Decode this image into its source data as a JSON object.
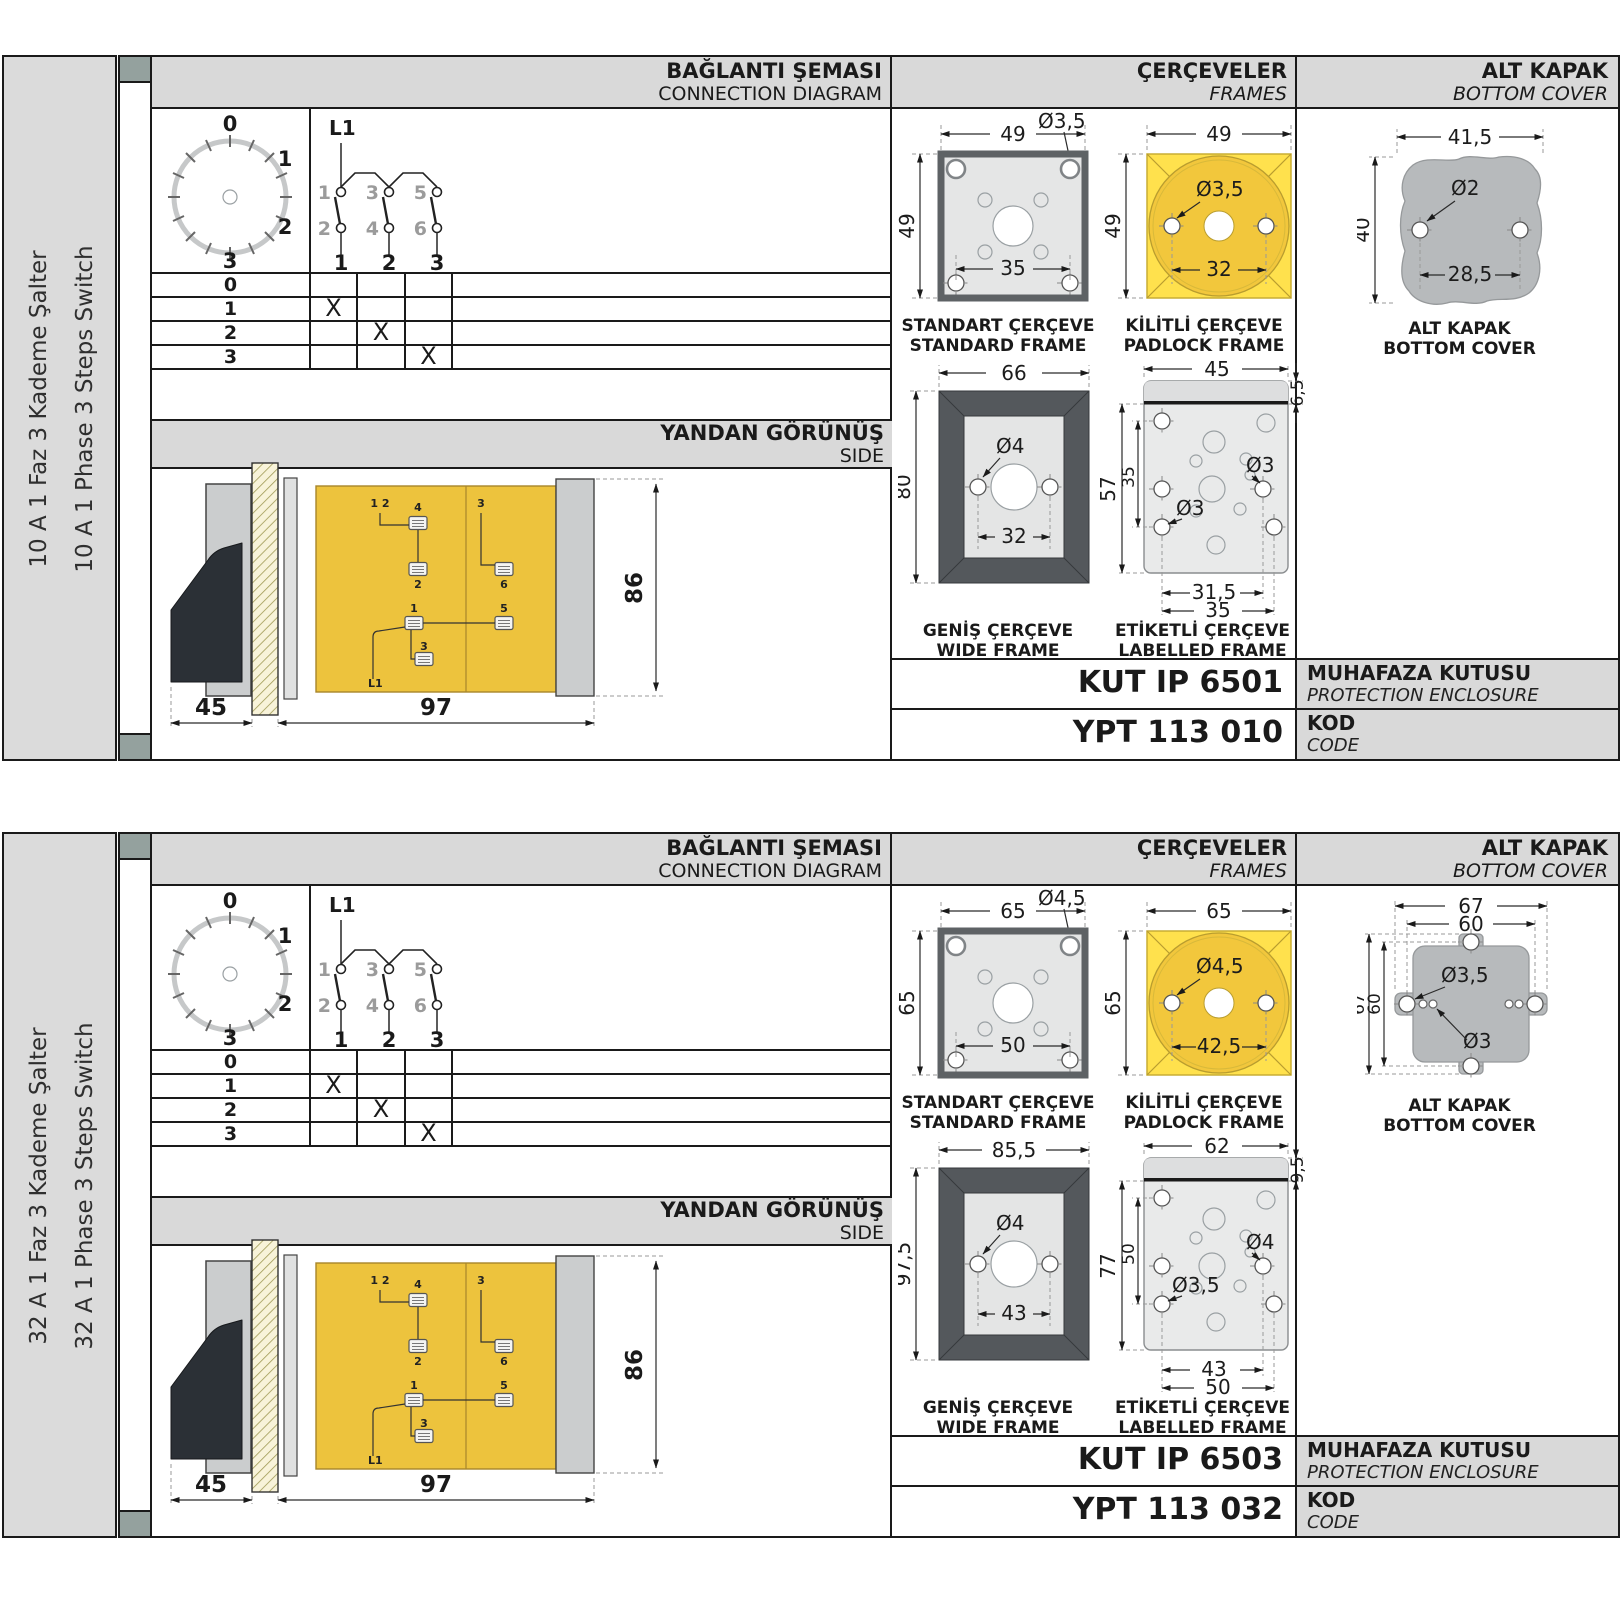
{
  "colors": {
    "panel_gray": "#d9d9d9",
    "sidebar_gray": "#dbdbdb",
    "square_teal": "#94a19e",
    "yellow_frame": "#ffe14d",
    "yellow_circle": "#f2c73c",
    "body_yellow": "#edc33d",
    "dark_frame": "#54585c",
    "cover_gray": "#b7babc"
  },
  "panels": [
    {
      "sidebar": {
        "tr": "10 A 1 Faz 3 Kademe Şalter",
        "en": "10 A 1 Phase 3 Steps Switch"
      },
      "header": {
        "connection_tr": "BAĞLANTI ŞEMASI",
        "connection_en": "CONNECTION DIAGRAM",
        "frames_tr": "ÇERÇEVELER",
        "frames_en": "FRAMES",
        "cover_tr": "ALT KAPAK",
        "cover_en": "BOTTOM COVER"
      },
      "diagram": {
        "phase": "L1",
        "dial": {
          "p0": "0",
          "p1": "1",
          "p2": "2",
          "p3": "3"
        },
        "t1": "1",
        "t2": "2",
        "t3": "3",
        "t4": "4",
        "t5": "5",
        "t6": "6",
        "c1": "1",
        "c2": "2",
        "c3": "3",
        "rows": [
          {
            "pos": "0",
            "m1": "",
            "m2": "",
            "m3": ""
          },
          {
            "pos": "1",
            "m1": "X",
            "m2": "",
            "m3": ""
          },
          {
            "pos": "2",
            "m1": "",
            "m2": "X",
            "m3": ""
          },
          {
            "pos": "3",
            "m1": "",
            "m2": "",
            "m3": "X"
          }
        ]
      },
      "side": {
        "title_tr": "YANDAN GÖRÜNÜŞ",
        "title_en": "SIDE",
        "dim_a": "45",
        "dim_b": "97",
        "dim_h": "86",
        "labels": {
          "n12": "1 2",
          "n3t": "3",
          "n4": "4",
          "n2": "2",
          "n6": "6",
          "n1": "1",
          "n5": "5",
          "n3b": "3",
          "phase": "L1"
        }
      },
      "frames": {
        "standard": {
          "title_tr": "STANDART ÇERÇEVE",
          "title_en": "STANDARD FRAME",
          "w": "49",
          "h": "49",
          "hole": "Ø3,5",
          "span": "35"
        },
        "padlock": {
          "title_tr": "KİLİTLİ ÇERÇEVE",
          "title_en": "PADLOCK FRAME",
          "w": "49",
          "h": "49",
          "hole": "Ø3,5",
          "span": "32"
        },
        "wide": {
          "title_tr": "GENİŞ ÇERÇEVE",
          "title_en": "WIDE FRAME",
          "w": "66",
          "h": "80",
          "hole": "Ø4",
          "span": "32"
        },
        "labelled": {
          "title_tr": "ETİKETLİ ÇERÇEVE",
          "title_en": "LABELLED FRAME",
          "w": "45",
          "band": "6,5",
          "h": "57",
          "inner_h": "35",
          "hole_mid": "Ø3",
          "hole_bot": "Ø3",
          "span_inner": "31,5",
          "span_outer": "35"
        }
      },
      "cover": {
        "caption_tr": "ALT KAPAK",
        "caption_en": "BOTTOM COVER",
        "w": "41,5",
        "h": "40",
        "hole": "Ø2",
        "span": "28,5"
      },
      "enclosure": {
        "code": "KUT IP 6501",
        "label_tr": "MUHAFAZA KUTUSU",
        "label_en": "PROTECTION ENCLOSURE"
      },
      "kod": {
        "code": "YPT 113 010",
        "label_tr": "KOD",
        "label_en": "CODE"
      }
    },
    {
      "sidebar": {
        "tr": "32 A 1 Faz 3 Kademe Şalter",
        "en": "32 A 1 Phase 3 Steps Switch"
      },
      "header": {
        "connection_tr": "BAĞLANTI ŞEMASI",
        "connection_en": "CONNECTION DIAGRAM",
        "frames_tr": "ÇERÇEVELER",
        "frames_en": "FRAMES",
        "cover_tr": "ALT KAPAK",
        "cover_en": "BOTTOM COVER"
      },
      "diagram": {
        "phase": "L1",
        "dial": {
          "p0": "0",
          "p1": "1",
          "p2": "2",
          "p3": "3"
        },
        "t1": "1",
        "t2": "2",
        "t3": "3",
        "t4": "4",
        "t5": "5",
        "t6": "6",
        "c1": "1",
        "c2": "2",
        "c3": "3",
        "rows": [
          {
            "pos": "0",
            "m1": "",
            "m2": "",
            "m3": ""
          },
          {
            "pos": "1",
            "m1": "X",
            "m2": "",
            "m3": ""
          },
          {
            "pos": "2",
            "m1": "",
            "m2": "X",
            "m3": ""
          },
          {
            "pos": "3",
            "m1": "",
            "m2": "",
            "m3": "X"
          }
        ]
      },
      "side": {
        "title_tr": "YANDAN GÖRÜNÜŞ",
        "title_en": "SIDE",
        "dim_a": "45",
        "dim_b": "97",
        "dim_h": "86",
        "labels": {
          "n12": "1 2",
          "n3t": "3",
          "n4": "4",
          "n2": "2",
          "n6": "6",
          "n1": "1",
          "n5": "5",
          "n3b": "3",
          "phase": "L1"
        }
      },
      "frames": {
        "standard": {
          "title_tr": "STANDART ÇERÇEVE",
          "title_en": "STANDARD FRAME",
          "w": "65",
          "h": "65",
          "hole": "Ø4,5",
          "span": "50"
        },
        "padlock": {
          "title_tr": "KİLİTLİ ÇERÇEVE",
          "title_en": "PADLOCK FRAME",
          "w": "65",
          "h": "65",
          "hole": "Ø4,5",
          "span": "42,5"
        },
        "wide": {
          "title_tr": "GENİŞ ÇERÇEVE",
          "title_en": "WIDE FRAME",
          "w": "85,5",
          "h": "97,5",
          "hole": "Ø4",
          "span": "43"
        },
        "labelled": {
          "title_tr": "ETİKETLİ ÇERÇEVE",
          "title_en": "LABELLED FRAME",
          "w": "62",
          "band": "9,5",
          "h": "77",
          "inner_h": "50",
          "hole_mid": "Ø4",
          "hole_bot": "Ø3,5",
          "span_inner": "43",
          "span_outer": "50"
        }
      },
      "cover": {
        "caption_tr": "ALT KAPAK",
        "caption_en": "BOTTOM COVER",
        "w_out": "67",
        "w_in": "60",
        "h_out": "67",
        "h_in": "60",
        "hole_big": "Ø3,5",
        "hole_small": "Ø3"
      },
      "enclosure": {
        "code": "KUT IP 6503",
        "label_tr": "MUHAFAZA KUTUSU",
        "label_en": "PROTECTION ENCLOSURE"
      },
      "kod": {
        "code": "YPT 113 032",
        "label_tr": "KOD",
        "label_en": "CODE"
      }
    }
  ]
}
